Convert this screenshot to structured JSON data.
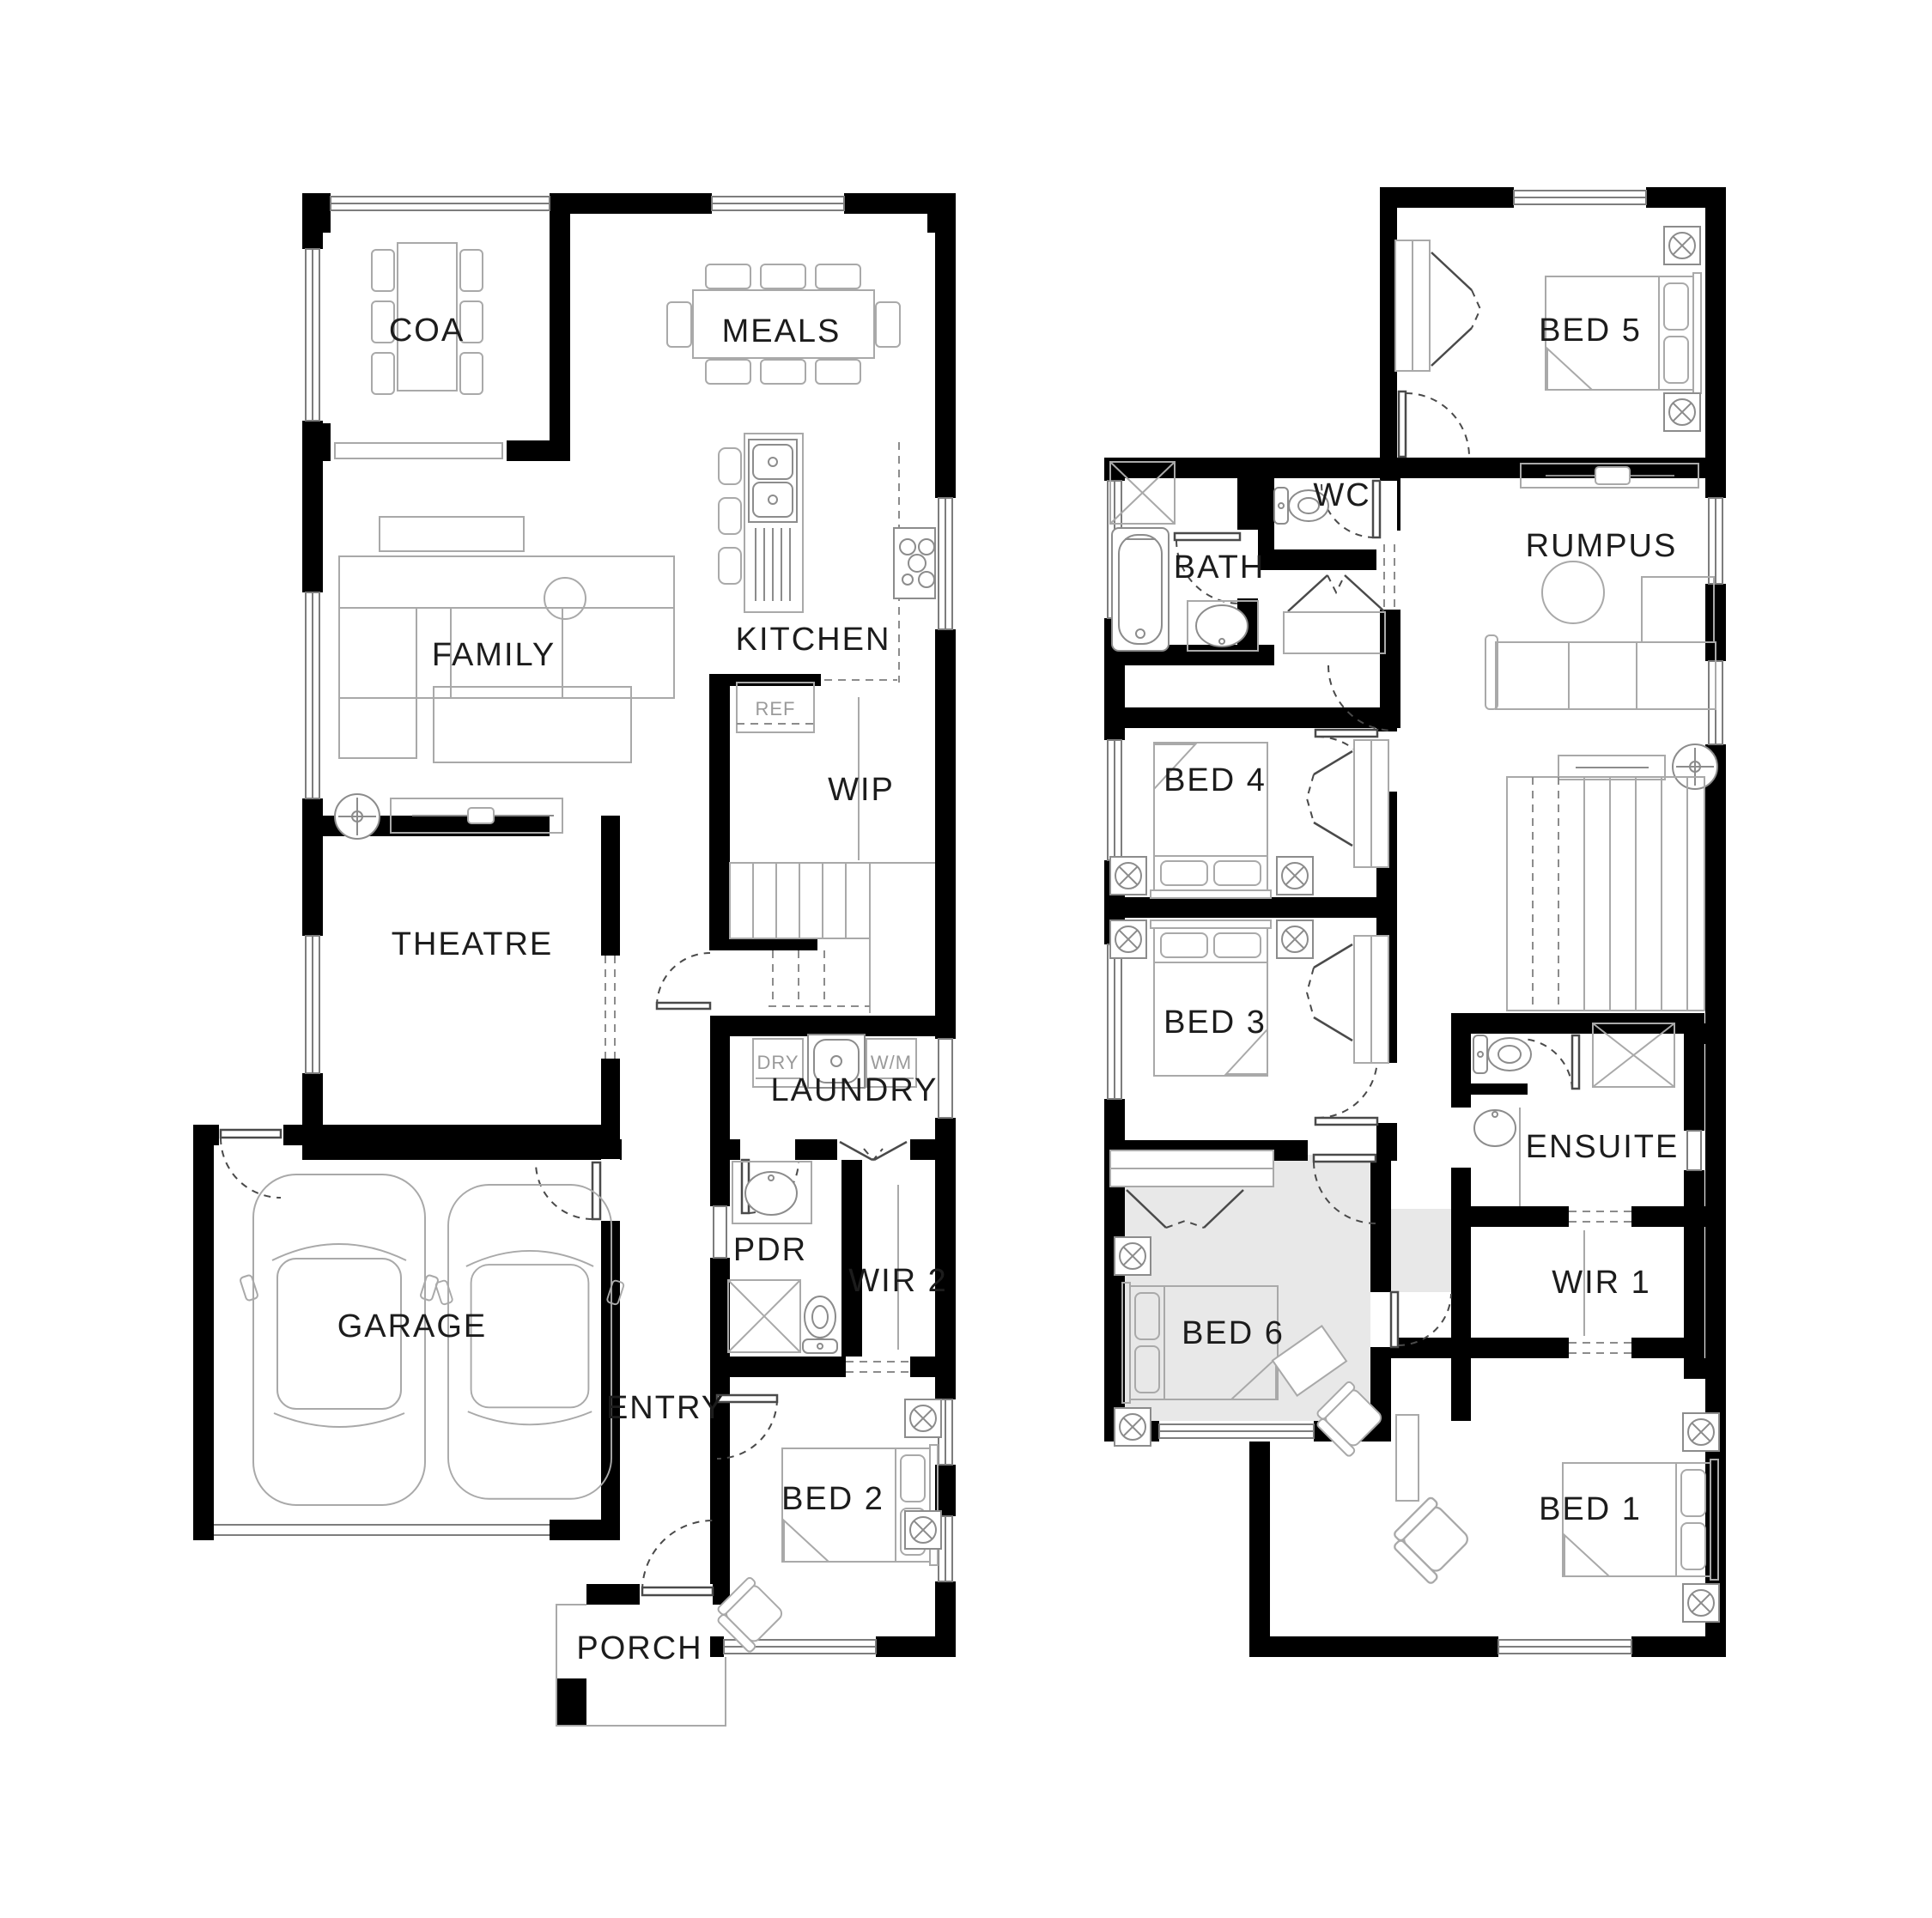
{
  "document": {
    "type": "residential floor plan, two storeys, black walls on white"
  },
  "colors": {
    "wall": "#000000",
    "furniture_line": "#a9a9a9",
    "fixture_line": "#8c8c8c",
    "door_line": "#4a4a4a",
    "highlight_room": "#e8e8e8",
    "label_text": "#1c1c1c",
    "appliance_text": "#9a9a9a"
  },
  "ground_floor": {
    "rooms": {
      "coa": {
        "label": "COA"
      },
      "meals": {
        "label": "MEALS"
      },
      "family": {
        "label": "FAMILY"
      },
      "kitchen": {
        "label": "KITCHEN"
      },
      "wip": {
        "label": "WIP"
      },
      "theatre": {
        "label": "THEATRE"
      },
      "laundry": {
        "label": "LAUNDRY"
      },
      "pdr": {
        "label": "PDR"
      },
      "wir2": {
        "label": "WIR 2"
      },
      "garage": {
        "label": "GARAGE"
      },
      "entry": {
        "label": "ENTRY"
      },
      "bed2": {
        "label": "BED 2"
      },
      "porch": {
        "label": "PORCH"
      }
    },
    "appliances": {
      "ref": "REF",
      "dryer": "DRY",
      "washer": "W/M"
    }
  },
  "upper_floor": {
    "rooms": {
      "bed5": {
        "label": "BED 5"
      },
      "wc": {
        "label": "WC"
      },
      "bath": {
        "label": "BATH"
      },
      "rumpus": {
        "label": "RUMPUS"
      },
      "bed4": {
        "label": "BED 4"
      },
      "bed3": {
        "label": "BED 3"
      },
      "ensuite": {
        "label": "ENSUITE"
      },
      "wir1": {
        "label": "WIR 1"
      },
      "bed6": {
        "label": "BED 6",
        "highlighted": true
      },
      "bed1": {
        "label": "BED 1"
      }
    }
  }
}
